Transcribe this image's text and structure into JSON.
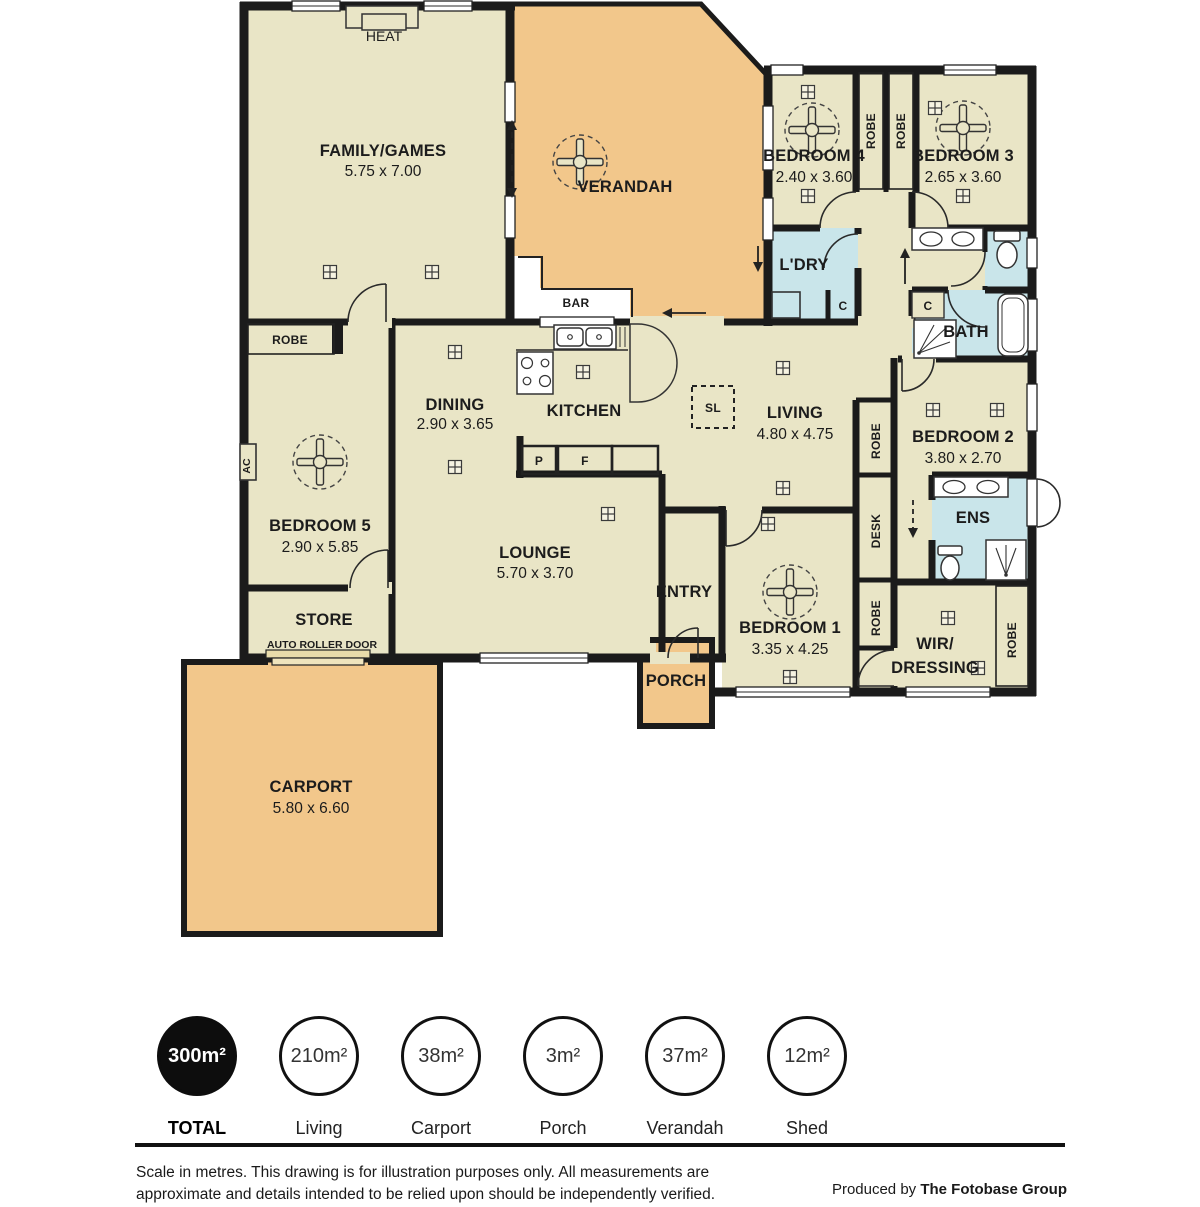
{
  "colors": {
    "floor": "#e9e5c6",
    "outdoor": "#f2c78b",
    "wet": "#c9e5ea",
    "wall": "#1b1b1b",
    "roller": "#e8dbaa"
  },
  "rooms": {
    "family": {
      "name": "FAMILY/GAMES",
      "dims": "5.75 x 7.00"
    },
    "verandah": {
      "name": "VERANDAH"
    },
    "bedroom4": {
      "name": "BEDROOM 4",
      "dims": "2.40 x 3.60"
    },
    "bedroom3": {
      "name": "BEDROOM 3",
      "dims": "2.65 x 3.60"
    },
    "laundry": {
      "name": "L'DRY"
    },
    "bath": {
      "name": "BATH"
    },
    "dining": {
      "name": "DINING",
      "dims": "2.90 x 3.65"
    },
    "kitchen": {
      "name": "KITCHEN"
    },
    "living": {
      "name": "LIVING",
      "dims": "4.80 x 4.75"
    },
    "bedroom2": {
      "name": "BEDROOM 2",
      "dims": "3.80 x 2.70"
    },
    "ensuite": {
      "name": "ENS"
    },
    "bedroom5": {
      "name": "BEDROOM 5",
      "dims": "2.90 x 5.85"
    },
    "store": {
      "name": "STORE",
      "sub": "AUTO ROLLER DOOR"
    },
    "lounge": {
      "name": "LOUNGE",
      "dims": "5.70 x 3.70"
    },
    "entry": {
      "name": "ENTRY"
    },
    "porch": {
      "name": "PORCH"
    },
    "bedroom1": {
      "name": "BEDROOM 1",
      "dims": "3.35 x 4.25"
    },
    "wir": {
      "name": "WIR/",
      "name2": "DRESSING"
    },
    "carport": {
      "name": "CARPORT",
      "dims": "5.80 x 6.60"
    }
  },
  "fixtures": {
    "heat": "HEAT",
    "bar": "BAR",
    "robe": "ROBE",
    "ac": "AC",
    "desk": "DESK",
    "sl": "SL",
    "c": "C",
    "p": "P",
    "f": "F"
  },
  "legend": {
    "items": [
      {
        "value": "300m²",
        "label": "TOTAL",
        "filled": true
      },
      {
        "value": "210m²",
        "label": "Living",
        "filled": false
      },
      {
        "value": "38m²",
        "label": "Carport",
        "filled": false
      },
      {
        "value": "3m²",
        "label": "Porch",
        "filled": false
      },
      {
        "value": "37m²",
        "label": "Verandah",
        "filled": false
      },
      {
        "value": "12m²",
        "label": "Shed",
        "filled": false
      }
    ]
  },
  "footer": {
    "disclaimer_line1": "Scale in metres. This drawing is for illustration purposes only. All measurements are",
    "disclaimer_line2": "approximate and details intended to be relied upon should be independently verified.",
    "produced_by": "Produced by ",
    "producer": "The Fotobase Group"
  }
}
